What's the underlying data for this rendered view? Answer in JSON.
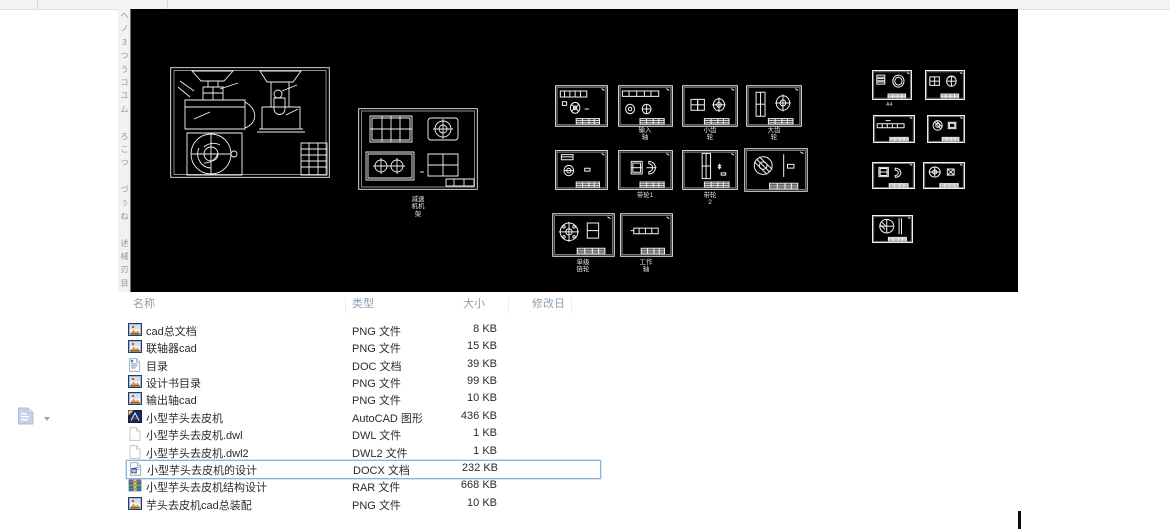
{
  "cad": {
    "labels": {
      "drawing2": "减速\n机机\n架",
      "a4": "A4",
      "input_shaft": "输入\n轴",
      "small_gear": "小齿\n轮",
      "big_gear": "大齿\n轮",
      "pulley1": "带轮1",
      "pulley2": "带轮\n2",
      "sprocket": "单级\n链轮",
      "work_shaft": "工作\n轴"
    }
  },
  "side_toolbar": {
    "glyphs": [
      "ヘ",
      "ノ",
      "3",
      "つ",
      "う",
      "コ",
      "ユ",
      "ム",
      "",
      "ろ",
      "こ",
      "つ",
      "",
      "づ",
      "ぅ",
      "ね",
      "",
      "述",
      "械",
      "刃",
      "目"
    ]
  },
  "file_list": {
    "columns": [
      {
        "label": "名称"
      },
      {
        "label": "类型"
      },
      {
        "label": "大小"
      },
      {
        "label": "修改日期"
      }
    ],
    "rows": [
      {
        "name": "cad总文档",
        "type": "PNG 文件",
        "size": "8 KB",
        "icon": "png",
        "selected": false
      },
      {
        "name": "联轴器cad",
        "type": "PNG 文件",
        "size": "15 KB",
        "icon": "png",
        "selected": false
      },
      {
        "name": "目录",
        "type": "DOC 文档",
        "size": "39 KB",
        "icon": "doc",
        "selected": false
      },
      {
        "name": "设计书目录",
        "type": "PNG 文件",
        "size": "99 KB",
        "icon": "png",
        "selected": false
      },
      {
        "name": "输出轴cad",
        "type": "PNG 文件",
        "size": "10 KB",
        "icon": "png",
        "selected": false
      },
      {
        "name": "小型芋头去皮机",
        "type": "AutoCAD 图形",
        "size": "436 KB",
        "icon": "dwg",
        "selected": false
      },
      {
        "name": "小型芋头去皮机.dwl",
        "type": "DWL 文件",
        "size": "1 KB",
        "icon": "blank",
        "selected": false
      },
      {
        "name": "小型芋头去皮机.dwl2",
        "type": "DWL2 文件",
        "size": "1 KB",
        "icon": "blank",
        "selected": false
      },
      {
        "name": "小型芋头去皮机的设计",
        "type": "DOCX 文档",
        "size": "232 KB",
        "icon": "docx",
        "selected": true
      },
      {
        "name": "小型芋头去皮机结构设计",
        "type": "RAR 文件",
        "size": "668 KB",
        "icon": "rar",
        "selected": false
      },
      {
        "name": "芋头去皮机cad总装配",
        "type": "PNG 文件",
        "size": "10 KB",
        "icon": "png",
        "selected": false
      }
    ]
  },
  "colors": {
    "selection_border": "#8fb0d8",
    "header_text": "#8fa0b2",
    "canvas_bg": "#000000",
    "line_color": "#f2f2f2"
  }
}
